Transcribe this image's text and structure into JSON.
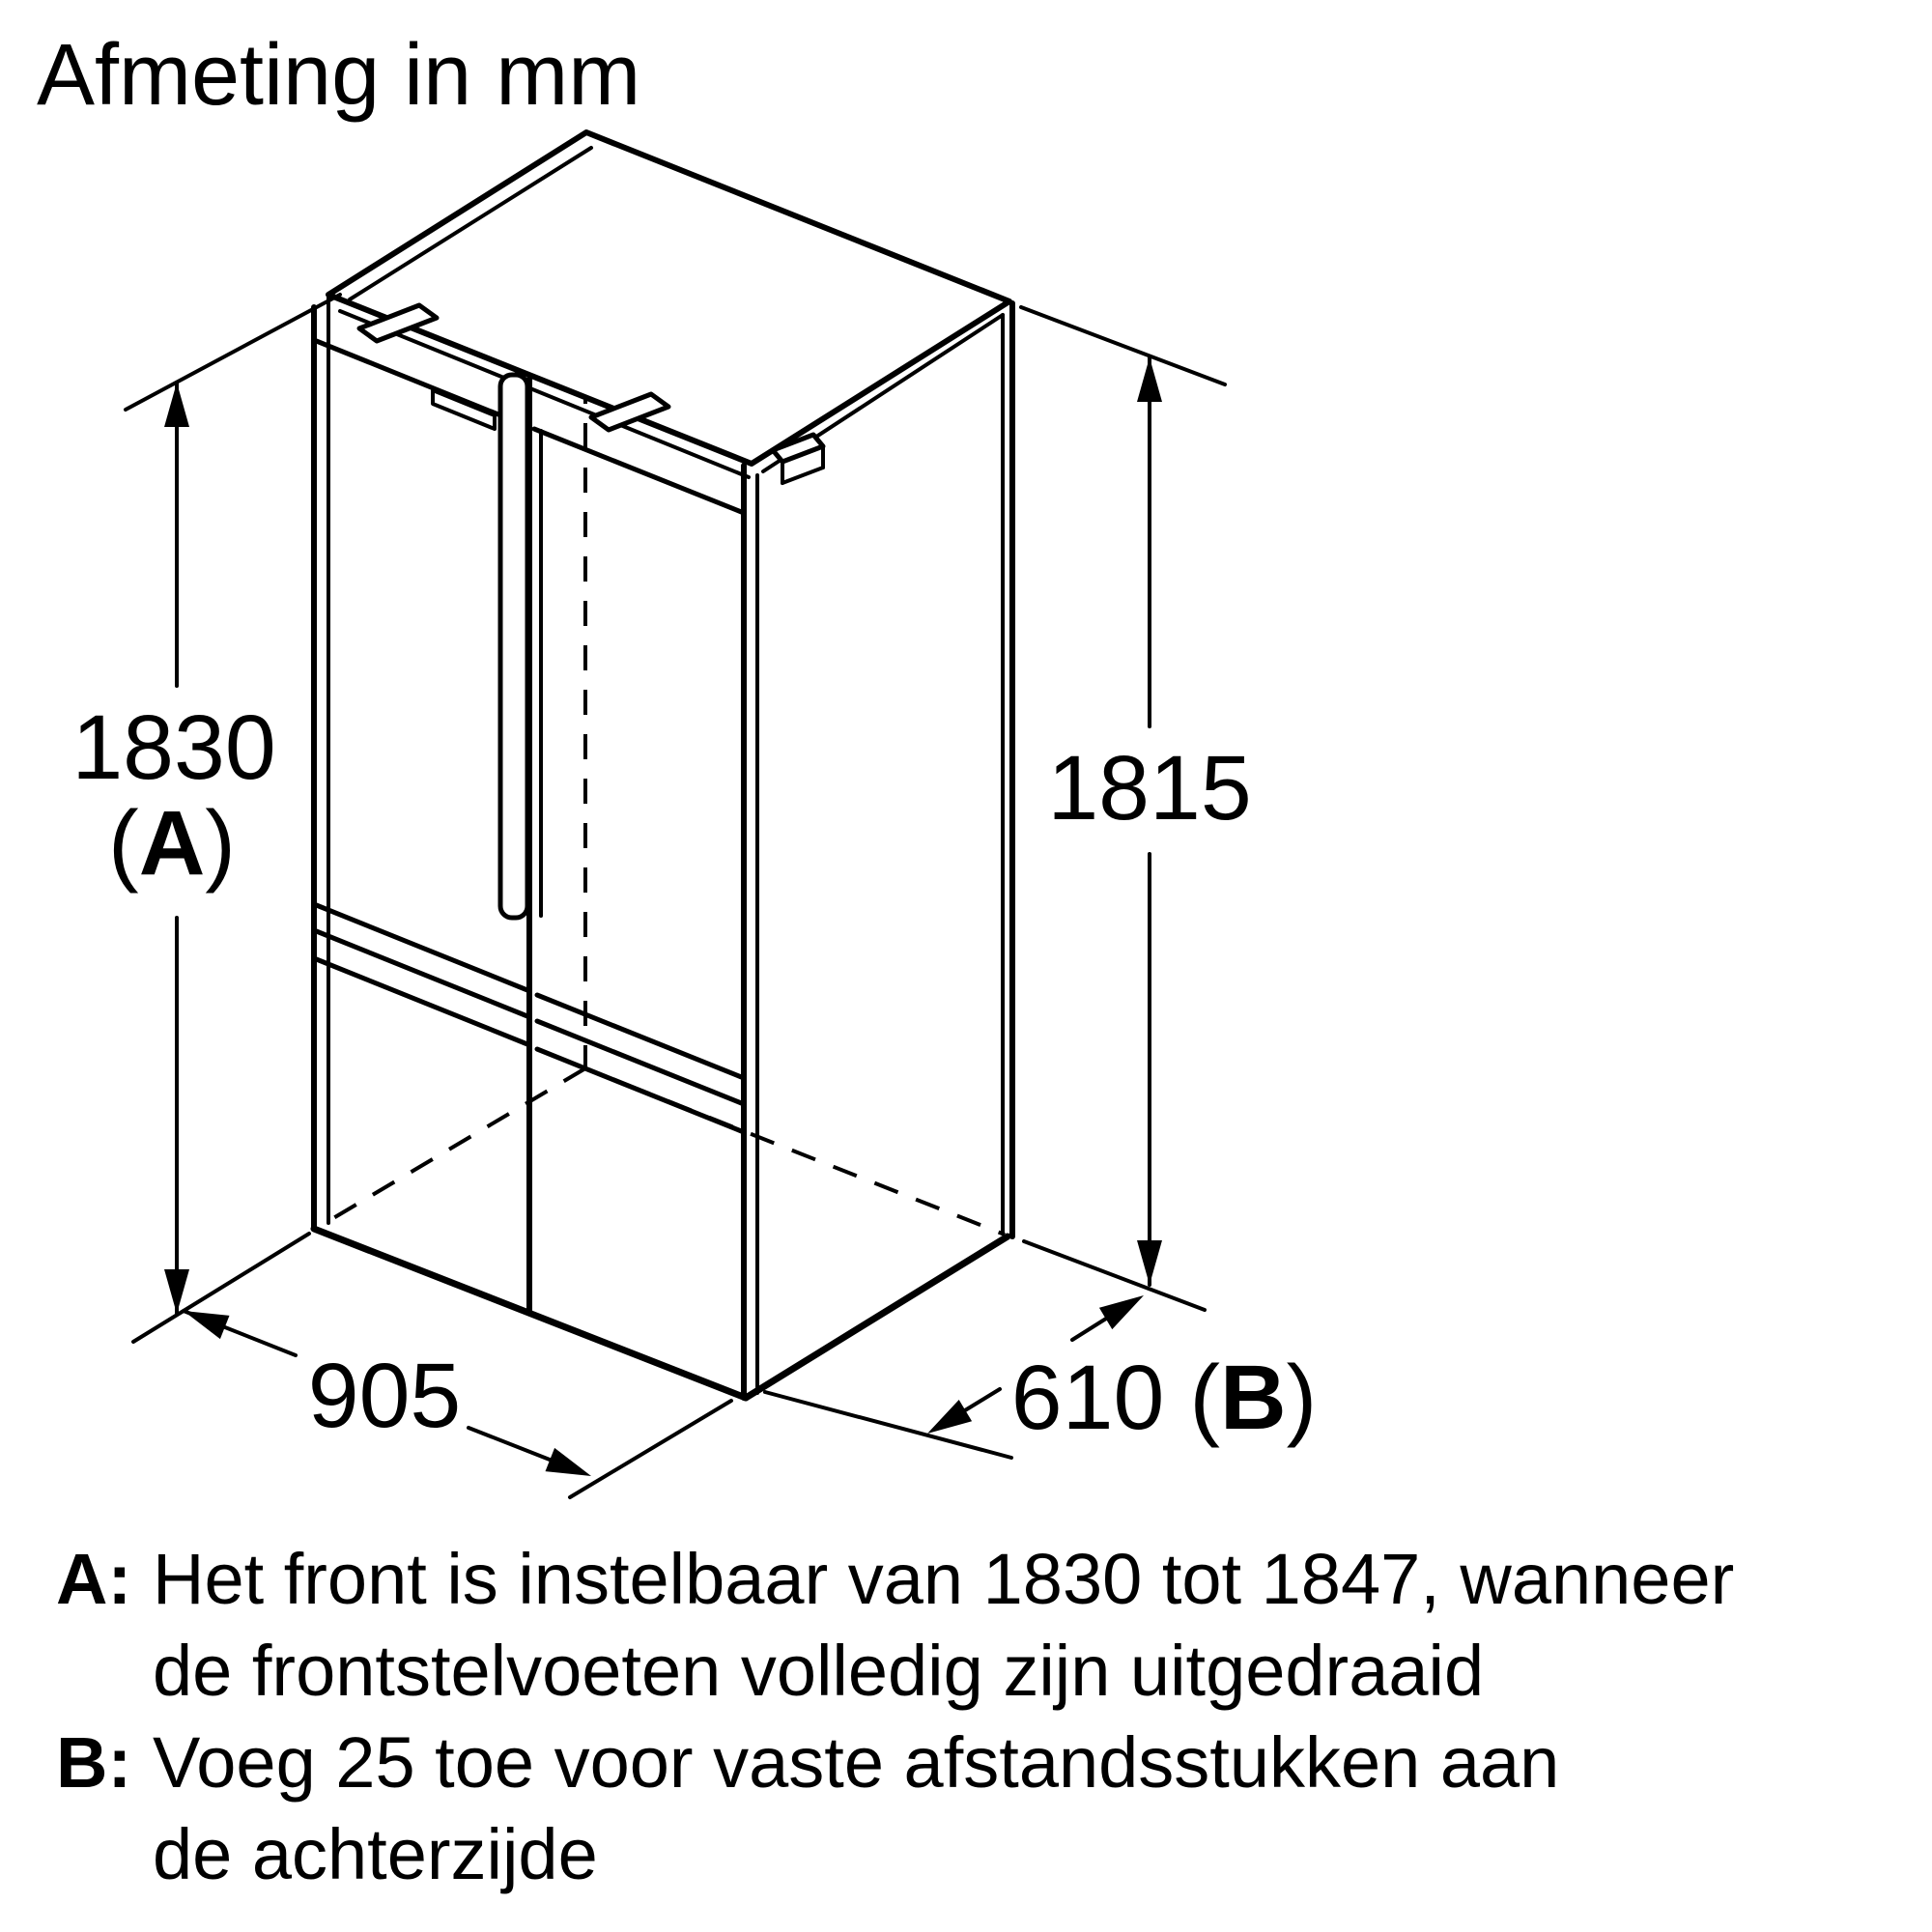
{
  "title": "Afmeting in mm",
  "colors": {
    "ink": "#000000",
    "background": "#ffffff"
  },
  "dimensions": {
    "front_height": {
      "value": "1830",
      "paren_open": "(",
      "letter": "A",
      "paren_close": ")"
    },
    "side_height": {
      "value": "1815"
    },
    "width": {
      "value": "905"
    },
    "depth": {
      "value": "610",
      "paren_open": "(",
      "letter": "B",
      "paren_close": ")"
    }
  },
  "notes": {
    "a": {
      "label": "A:",
      "line1": "Het front is instelbaar van 1830 tot 1847, wanneer",
      "line2": "de frontstelvoeten volledig zijn uitgedraaid"
    },
    "b": {
      "label": "B:",
      "line1": "Voeg 25 toe voor vaste afstandsstukken aan",
      "line2": "de achterzijde"
    }
  }
}
